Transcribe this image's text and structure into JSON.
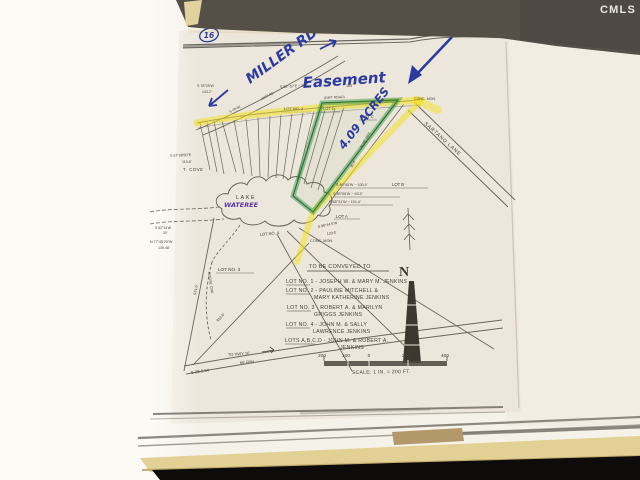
{
  "watermark": "CMLS",
  "handwriting": {
    "road_name": "MILLER RD",
    "easement": "Easement",
    "acreage": "4.09 ACRES",
    "circled_number": "16",
    "lake_name": "WATEREE"
  },
  "plat": {
    "labels": {
      "lake": "LAKE",
      "cove": "T. COVE",
      "lot_a": "LOT A",
      "lot_b": "LOT B",
      "lot_c": "LOT C",
      "lot_d": "LOT D",
      "lot_no_2": "LOT NO. 2",
      "lot_no_3": "LOT NO. 3",
      "lot_no_4": "LOT NO. 4",
      "lane": "SARTANO LANE",
      "dirt_road": "(DIRT ROAD)",
      "road_band_id": "S-78-50",
      "road_band_type": "DIRT RD",
      "conc_mon": "CONC. MON.",
      "creek": "GOOSE CRK",
      "to_hwy": "TO HWY. 97",
      "right_of_way": "66' R/W",
      "state_road": "S-28-0.54",
      "north": "N"
    },
    "bearings": [
      {
        "text": "S 78°25'W"
      },
      {
        "text": "143.2'"
      },
      {
        "text": "S 88°-57'E ~ 207'"
      },
      {
        "text": "183'"
      },
      {
        "text": "S 57°08'50\"E"
      },
      {
        "text": "119.8'"
      },
      {
        "text": "S 62°14'W"
      },
      {
        "text": "30'"
      },
      {
        "text": "N 77°45'20\"W"
      },
      {
        "text": "139.48'"
      },
      {
        "text": "S 89°45'W ~ 100.0'"
      },
      {
        "text": "S 85°06'W ~ 93.5'"
      },
      {
        "text": "N 85°31'W ~ 101.4'"
      },
      {
        "text": "S 88°44.5'W"
      },
      {
        "text": "133.5'"
      },
      {
        "text": "N 28°-30'E"
      },
      {
        "text": "30.4'"
      },
      {
        "text": "974.6'"
      },
      {
        "text": "916.6'"
      }
    ],
    "conveyance": {
      "heading": "TO BE CONVEYED TO",
      "items": [
        {
          "line1": "LOT NO. 1 - JOSEPH W. & MARY M. JENKINS",
          "line2": ""
        },
        {
          "line1": "LOT NO. 2 - PAULINE MITCHELL &",
          "line2": "MARY KATHERINE JENKINS"
        },
        {
          "line1": "LOT NO. 3 - ROBERT A. & MARILYN",
          "line2": "GRIGGS JENKINS"
        },
        {
          "line1": "LOT NO. 4 - JOHN M. & SALLY",
          "line2": "LAWRENCE JENKINS"
        },
        {
          "line1": "LOTS A,B,C,D - JOHN M. & ROBERT A.",
          "line2": "JENKINS"
        }
      ]
    },
    "scale": {
      "ticks": [
        "200",
        "100",
        "0",
        "200",
        "400"
      ],
      "label": "SCALE: 1 IN. = 200 FT."
    }
  }
}
